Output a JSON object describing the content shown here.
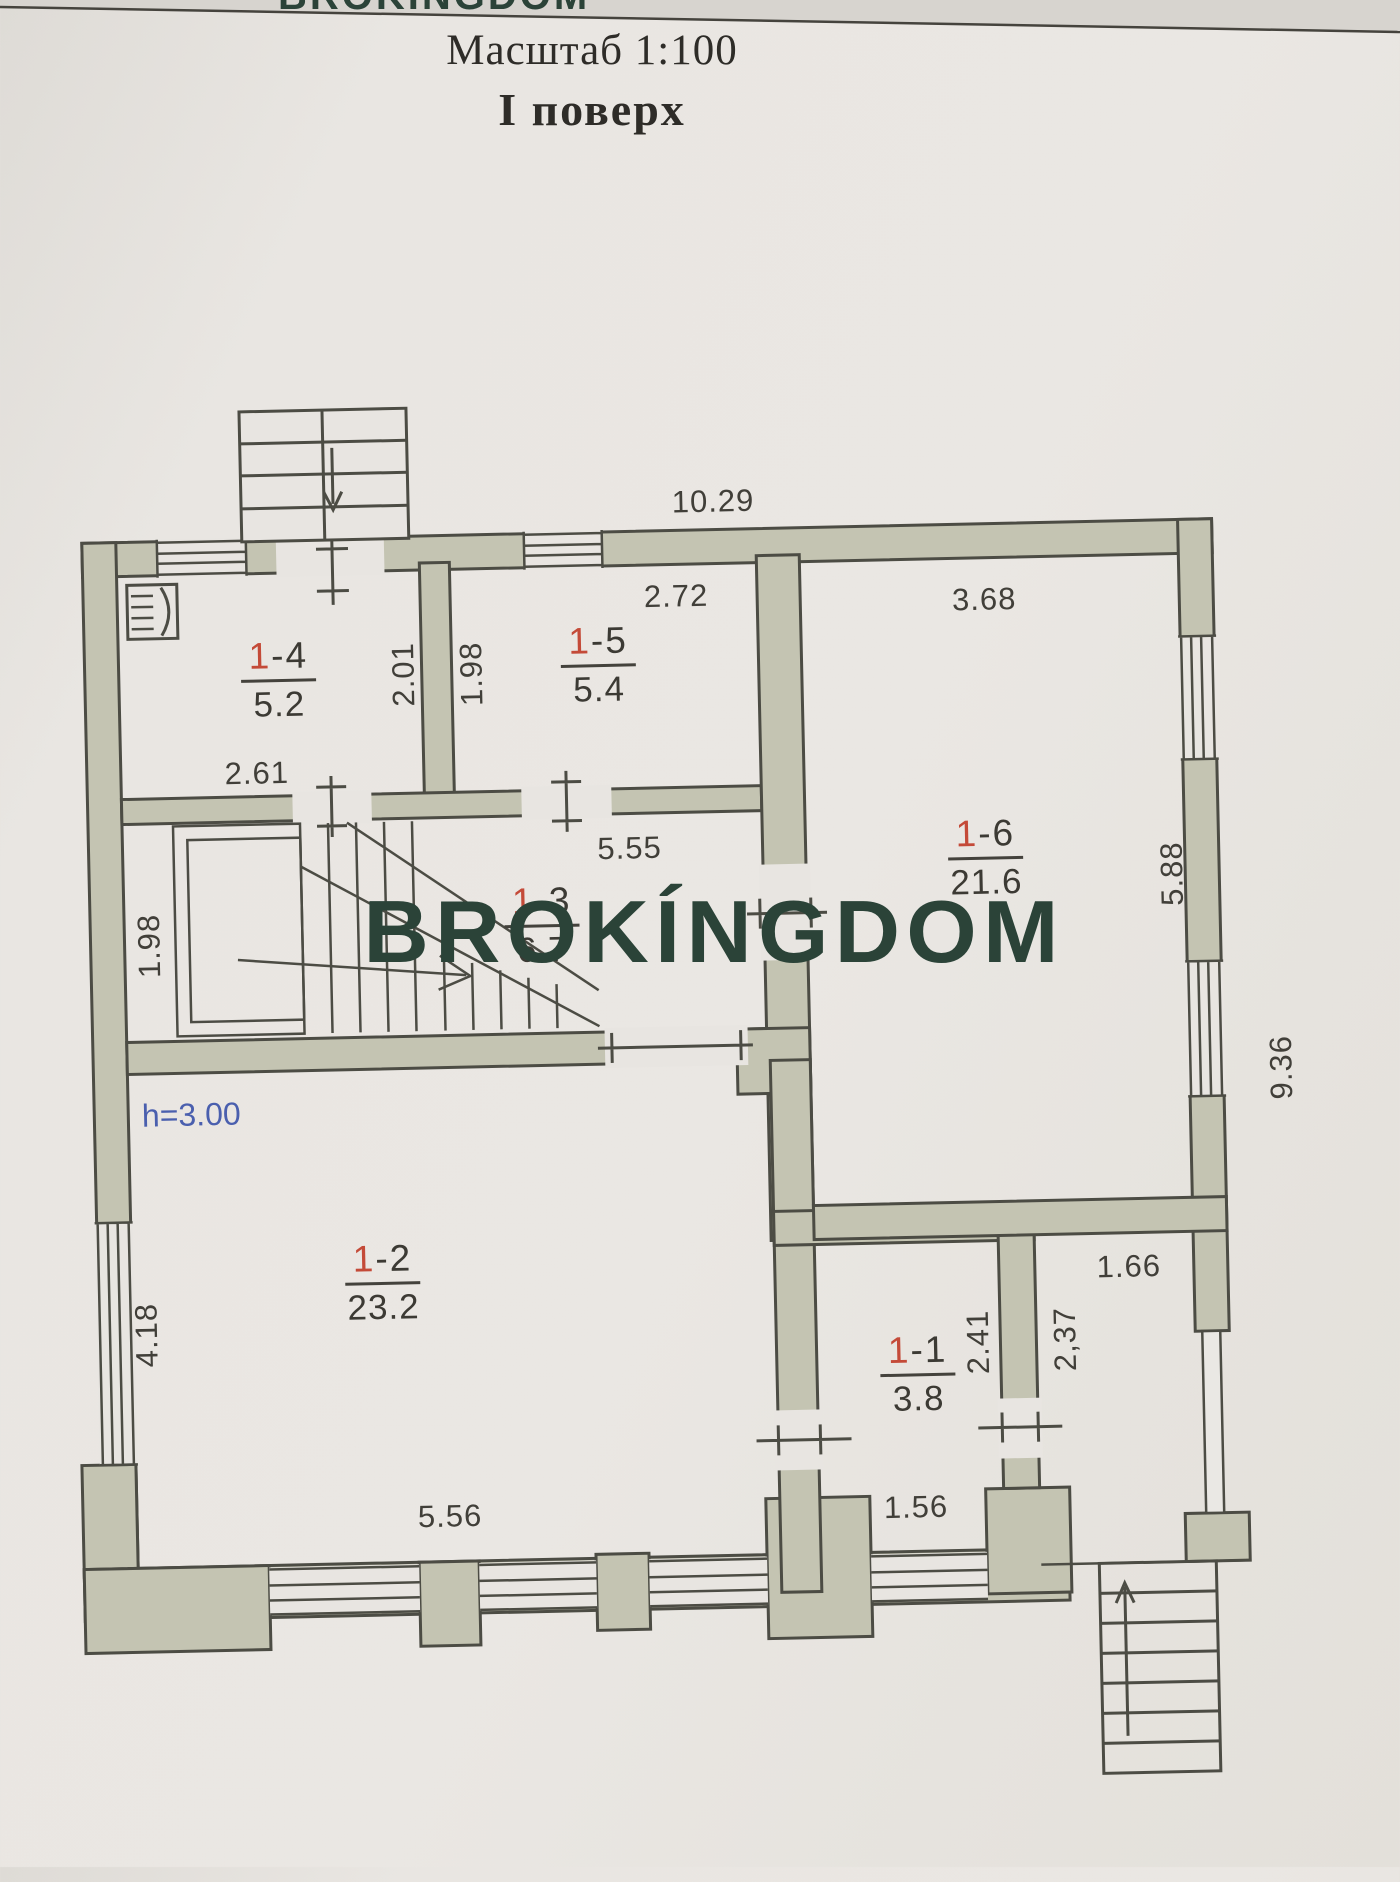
{
  "document": {
    "scale_label": "Масштаб 1:100",
    "floor_label": "І поверх"
  },
  "watermark": {
    "text": "BROKÍNGDOM",
    "top_fragment": "BROKÍNGDOM",
    "color": "#2b4338"
  },
  "rooms": [
    {
      "number_prefix": "1",
      "number_suffix": "-1",
      "area": "3.8",
      "x": 911,
      "y": 1336
    },
    {
      "number_prefix": "1",
      "number_suffix": "-2",
      "area": "23.2",
      "x": 378,
      "y": 1233
    },
    {
      "number_prefix": "1",
      "number_suffix": "-3",
      "area": "6.7",
      "x": 545,
      "y": 879
    },
    {
      "number_prefix": "1",
      "number_suffix": "-4",
      "area": "5.2",
      "x": 287,
      "y": 628
    },
    {
      "number_prefix": "1",
      "number_suffix": "-5",
      "area": "5.4",
      "x": 607,
      "y": 620
    },
    {
      "number_prefix": "1",
      "number_suffix": "-6",
      "area": "21.6",
      "x": 990,
      "y": 821
    }
  ],
  "dimensions": [
    {
      "text": "10.29",
      "x": 725,
      "y": 502,
      "rot": 0
    },
    {
      "text": "2.72",
      "x": 686,
      "y": 596,
      "rot": 0
    },
    {
      "text": "3.68",
      "x": 994,
      "y": 606,
      "rot": 0
    },
    {
      "text": "2.01",
      "x": 412,
      "y": 668,
      "rot": -90
    },
    {
      "text": "1.98",
      "x": 480,
      "y": 669,
      "rot": -90
    },
    {
      "text": "2.61",
      "x": 263,
      "y": 764,
      "rot": 0
    },
    {
      "text": "5.55",
      "x": 634,
      "y": 847,
      "rot": 0
    },
    {
      "text": "1.98",
      "x": 152,
      "y": 934,
      "rot": -90
    },
    {
      "text": "5.88",
      "x": 1176,
      "y": 884,
      "rot": -90
    },
    {
      "text": "9.36",
      "x": 1281,
      "y": 1080,
      "rot": -90
    },
    {
      "text": "h=3.00",
      "x": 190,
      "y": 1104,
      "rot": 0,
      "style": "height"
    },
    {
      "text": "4.18",
      "x": 141,
      "y": 1323,
      "rot": -90
    },
    {
      "text": "5.56",
      "x": 440,
      "y": 1511,
      "rot": 0
    },
    {
      "text": "1.56",
      "x": 906,
      "y": 1512,
      "rot": 0
    },
    {
      "text": "2.41",
      "x": 972,
      "y": 1348,
      "rot": -90
    },
    {
      "text": "2,37",
      "x": 1059,
      "y": 1347,
      "rot": -90
    },
    {
      "text": "1.66",
      "x": 1124,
      "y": 1276,
      "rot": 0
    }
  ],
  "colors": {
    "wall_fill": "#c4c4b2",
    "line": "#4c4c44",
    "paper": "#e8e5e1",
    "room_number_red": "#c44a38",
    "dimension_text": "#413f39",
    "height_note_blue": "#4a5fae",
    "watermark_green": "#2b4338"
  }
}
